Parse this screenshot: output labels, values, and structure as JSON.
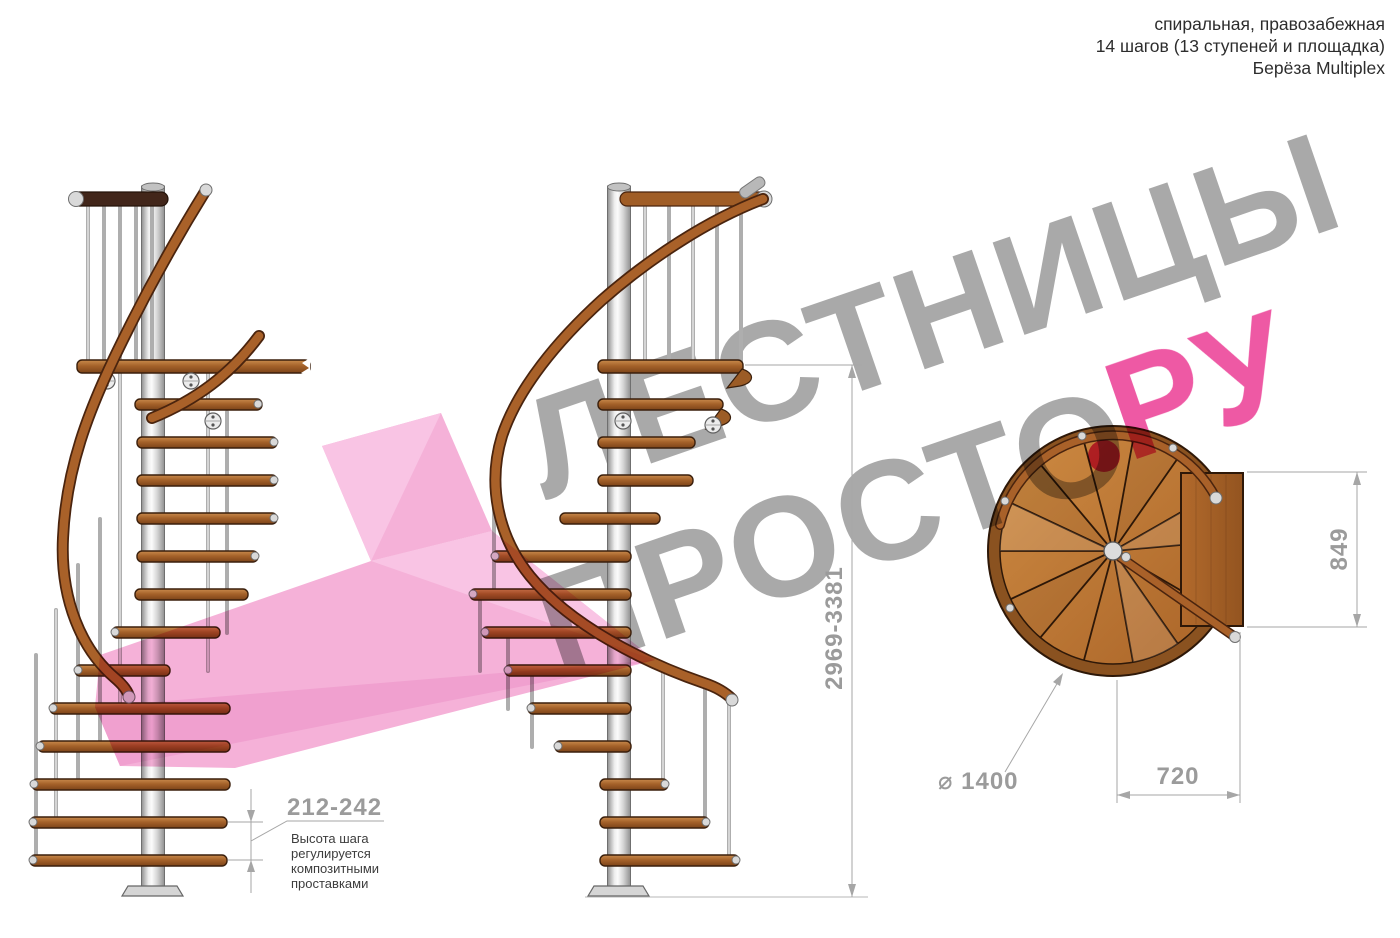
{
  "title_block": {
    "line1": "спиральная, правозабежная",
    "line2": "14 шагов (13 ступеней и площадка)",
    "line3": "Берёза Multiplex"
  },
  "watermark": {
    "word1": "ЛЕСТНИЦЫ",
    "word2": "ПРОСТО",
    "suffix": "РУ",
    "text_color": "#9e9e9e",
    "accent_color": "#e23c8e",
    "shape_color": "#f5b1d8"
  },
  "dimensions": {
    "step_height": {
      "value": "212-242",
      "note": [
        "Высота шага",
        "регулируется",
        "композитными",
        "проставками"
      ]
    },
    "total_height": {
      "value": "2969-3381"
    },
    "plan_depth": {
      "value": "849"
    },
    "plan_width": {
      "value": "720"
    },
    "plan_diameter": {
      "value": "⌀ 1400"
    }
  },
  "materials": {
    "wood": "#a5622a",
    "wood_dark": "#3a1f0c",
    "metal": "#d8d8d8",
    "dim_color": "#9b9b9b"
  }
}
